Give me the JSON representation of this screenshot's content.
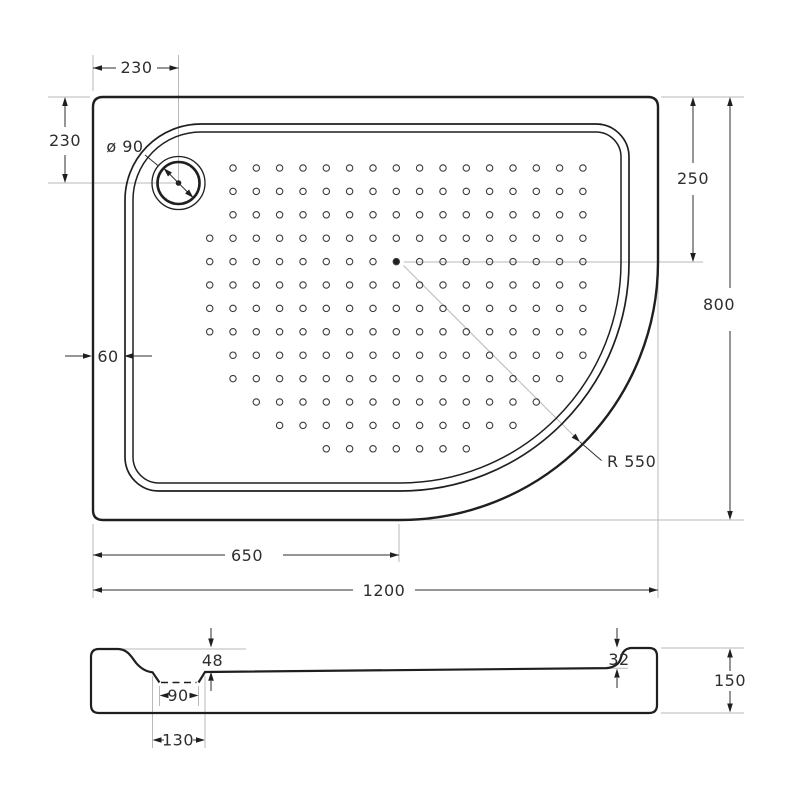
{
  "drawing_title": "shower tray technical drawing",
  "top_view": {
    "offset_top": "230",
    "offset_left": "230",
    "drain_diameter": "ø 90",
    "center_from_top": "250",
    "overall_height": "800",
    "rim_width": "60",
    "corner_radius": "R 550",
    "center_from_left": "650",
    "overall_width": "1200"
  },
  "profile_view": {
    "depth_left": "48",
    "depth_right": "32",
    "recess_width_inner": "90",
    "recess_width_outer": "130",
    "overall_height": "150"
  },
  "colors": {
    "line": "#1f1f1f",
    "auxiliary": "#b9b9b9",
    "background": "#ffffff"
  }
}
